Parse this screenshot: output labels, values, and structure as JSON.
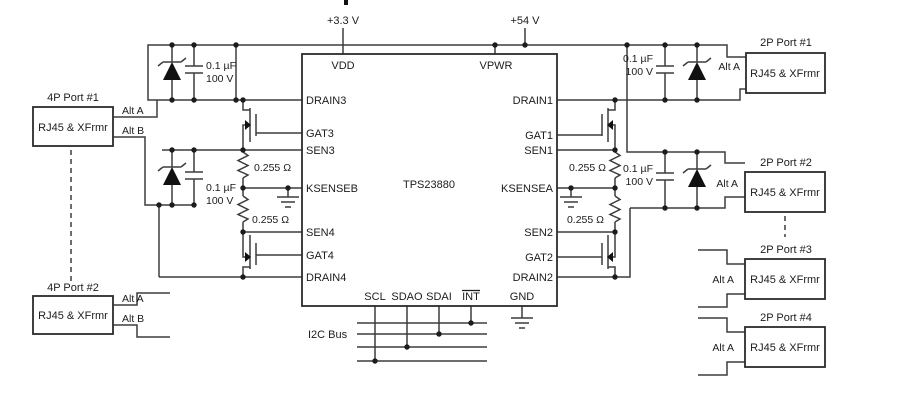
{
  "supplies": {
    "v3": "+3.3 V",
    "v54": "+54 V"
  },
  "ic": {
    "part": "TPS23880",
    "pins": {
      "vdd": "VDD",
      "vpwr": "VPWR",
      "drain3": "DRAIN3",
      "gat3": "GAT3",
      "sen3": "SEN3",
      "ksenseb": "KSENSEB",
      "sen4": "SEN4",
      "gat4": "GAT4",
      "drain4": "DRAIN4",
      "drain1": "DRAIN1",
      "gat1": "GAT1",
      "sen1": "SEN1",
      "ksensea": "KSENSEA",
      "sen2": "SEN2",
      "gat2": "GAT2",
      "drain2": "DRAIN2",
      "scl": "SCL",
      "sdao": "SDAO",
      "sdai": "SDAI",
      "int": "INT",
      "gnd": "GND"
    }
  },
  "components": {
    "cap_value": "0.1 µF",
    "cap_voltage": "100 V",
    "sense_resistor": "0.255 Ω"
  },
  "labels": {
    "i2c_bus": "I2C Bus",
    "alt_a": "Alt A",
    "alt_b": "Alt B",
    "rj45": "RJ45 & XFrmr"
  },
  "ports": {
    "left": [
      {
        "name": "4P Port #1"
      },
      {
        "name": "4P Port #2"
      }
    ],
    "right": [
      {
        "name": "2P Port #1"
      },
      {
        "name": "2P Port #2"
      },
      {
        "name": "2P Port #3"
      },
      {
        "name": "2P Port #4"
      }
    ]
  }
}
